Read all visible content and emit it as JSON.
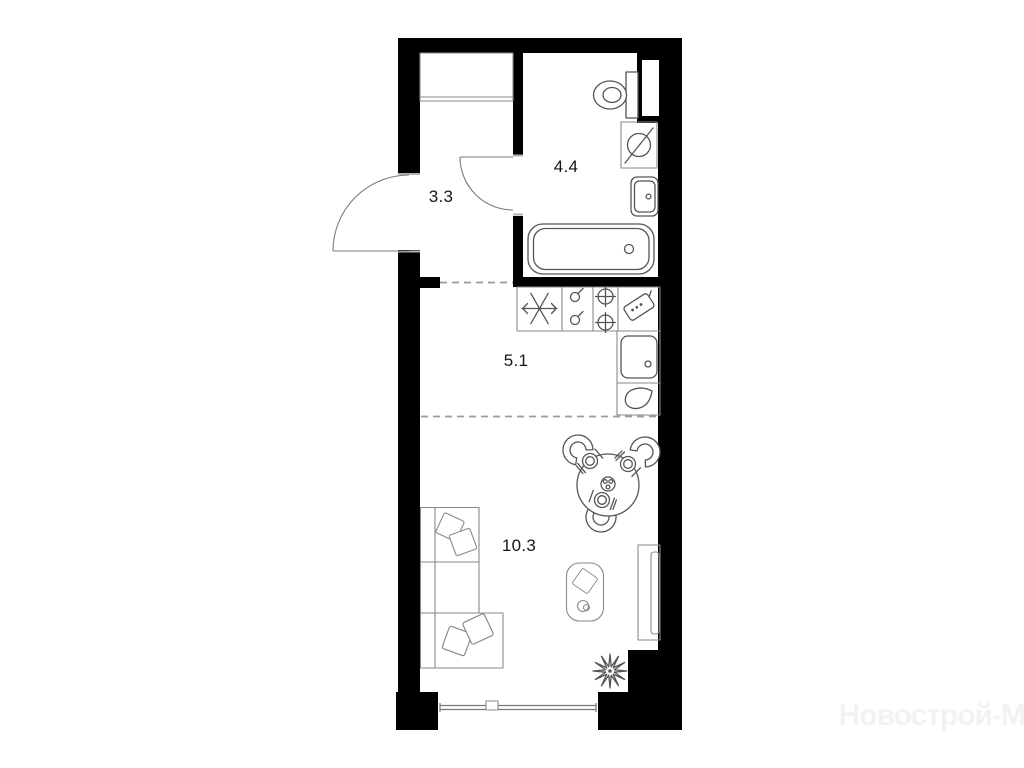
{
  "plan": {
    "background_color": "#ffffff",
    "wall_color": "#000000",
    "fixture_line_color": "#555555",
    "furniture_line_color": "#8a8a8a",
    "dashed_line_color": "#9b9b9b",
    "label_color": "#161616",
    "rooms": [
      {
        "name": "hallway",
        "area_label": "3.3"
      },
      {
        "name": "bathroom",
        "area_label": "4.4"
      },
      {
        "name": "kitchen",
        "area_label": "5.1"
      },
      {
        "name": "living-room",
        "area_label": "10.3"
      }
    ],
    "fixtures": [
      "entrance-door",
      "wardrobe",
      "bathroom-door",
      "toilet",
      "ventilation-shaft",
      "washing-machine",
      "bathroom-sink",
      "bathtub",
      "fridge",
      "stove",
      "cutting-board",
      "kitchen-sink",
      "kettle",
      "dining-table",
      "chairs",
      "place-settings",
      "sofa",
      "pillows",
      "armchair",
      "tv-stand",
      "plant",
      "balcony-window"
    ],
    "watermark": {
      "text": "Новострой-М",
      "color": "#f2f2f2"
    }
  }
}
